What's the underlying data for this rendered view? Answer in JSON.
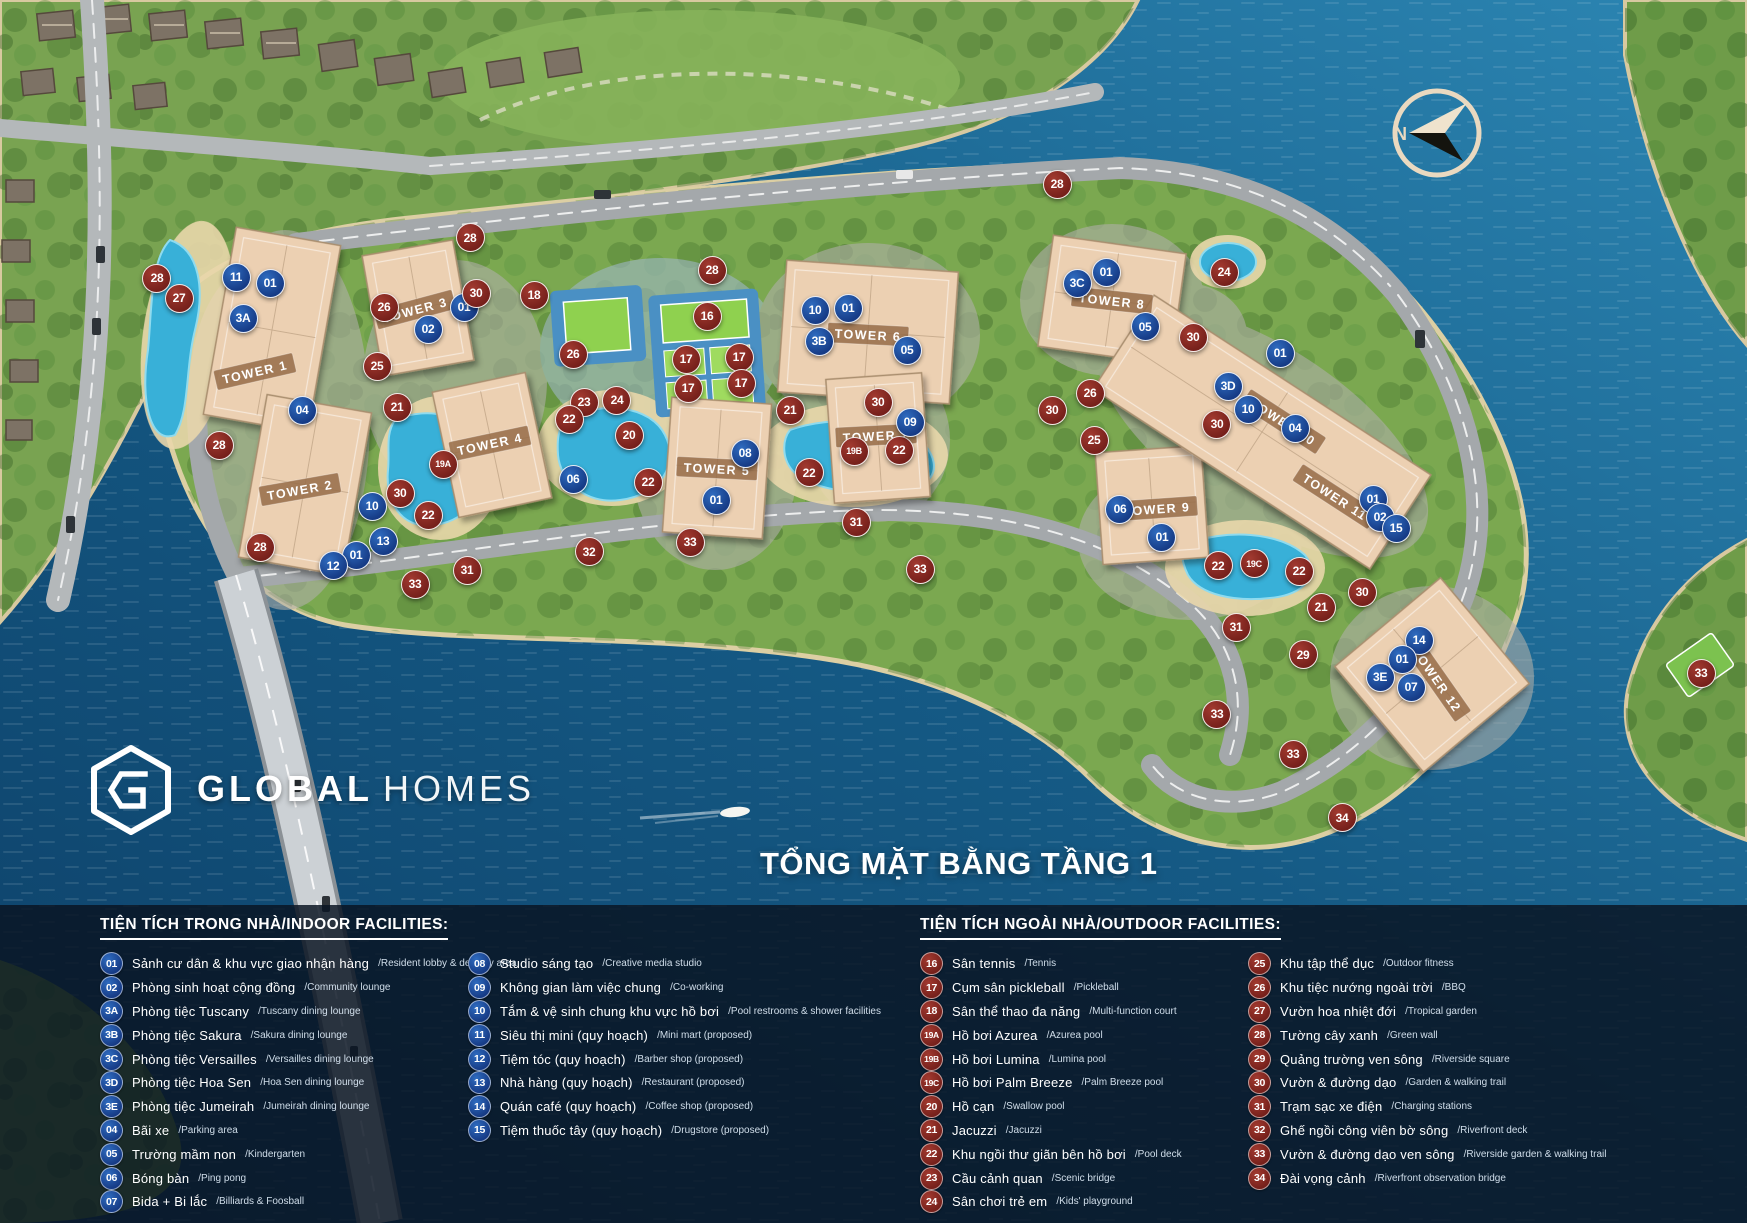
{
  "title": "TỔNG MẶT BẰNG TẦNG 1",
  "logo": {
    "bold": "GLOBAL",
    "light": "HOMES"
  },
  "compass": {
    "label": "N"
  },
  "palette": {
    "indoor_badge": "#1d4e9e",
    "outdoor_badge": "#8e2b28",
    "water": "#11557e",
    "land_green": "#79a351",
    "tower_fill": "#ecd0b2",
    "panel": "#0a1423",
    "pool": "#38b0d8"
  },
  "legend": {
    "indoor": {
      "header": "TIỆN TÍCH TRONG NHÀ/INDOOR FACILITIES:",
      "columns": [
        [
          {
            "id": "01",
            "vi": "Sảnh cư dân & khu vực giao nhận hàng",
            "en": "Resident lobby & delivery area"
          },
          {
            "id": "02",
            "vi": "Phòng sinh hoạt cộng đồng",
            "en": "Community lounge"
          },
          {
            "id": "3A",
            "vi": "Phòng tiệc Tuscany",
            "en": "Tuscany dining lounge"
          },
          {
            "id": "3B",
            "vi": "Phòng tiệc Sakura",
            "en": "Sakura dining lounge"
          },
          {
            "id": "3C",
            "vi": "Phòng tiệc Versailles",
            "en": "Versailles dining lounge"
          },
          {
            "id": "3D",
            "vi": "Phòng tiệc Hoa Sen",
            "en": "Hoa Sen dining lounge"
          },
          {
            "id": "3E",
            "vi": "Phòng tiệc Jumeirah",
            "en": "Jumeirah dining lounge"
          },
          {
            "id": "04",
            "vi": "Bãi xe",
            "en": "Parking area"
          },
          {
            "id": "05",
            "vi": "Trường mầm non",
            "en": "Kindergarten"
          },
          {
            "id": "06",
            "vi": "Bóng bàn",
            "en": "Ping pong"
          },
          {
            "id": "07",
            "vi": "Bida + Bi lắc",
            "en": "Billiards & Foosball"
          }
        ],
        [
          {
            "id": "08",
            "vi": "Studio sáng tạo",
            "en": "Creative media studio"
          },
          {
            "id": "09",
            "vi": "Không gian làm việc chung",
            "en": "Co-working"
          },
          {
            "id": "10",
            "vi": "Tắm & vệ sinh chung khu vực hồ bơi",
            "en": "Pool restrooms & shower facilities"
          },
          {
            "id": "11",
            "vi": "Siêu thị mini (quy hoạch)",
            "en": "Mini mart (proposed)"
          },
          {
            "id": "12",
            "vi": "Tiệm tóc (quy hoạch)",
            "en": "Barber shop (proposed)"
          },
          {
            "id": "13",
            "vi": "Nhà hàng (quy hoạch)",
            "en": "Restaurant (proposed)"
          },
          {
            "id": "14",
            "vi": "Quán café (quy hoạch)",
            "en": "Coffee shop (proposed)"
          },
          {
            "id": "15",
            "vi": "Tiệm thuốc tây (quy hoạch)",
            "en": "Drugstore (proposed)"
          }
        ]
      ]
    },
    "outdoor": {
      "header": "TIỆN TÍCH NGOÀI NHÀ/OUTDOOR FACILITIES:",
      "columns": [
        [
          {
            "id": "16",
            "vi": "Sân tennis",
            "en": "Tennis"
          },
          {
            "id": "17",
            "vi": "Cụm sân pickleball",
            "en": "Pickleball"
          },
          {
            "id": "18",
            "vi": "Sân thể thao đa năng",
            "en": "Multi-function court"
          },
          {
            "id": "19A",
            "vi": "Hồ bơi Azurea",
            "en": "Azurea pool"
          },
          {
            "id": "19B",
            "vi": "Hồ bơi Lumina",
            "en": "Lumina pool"
          },
          {
            "id": "19C",
            "vi": "Hồ bơi Palm Breeze",
            "en": "Palm Breeze pool"
          },
          {
            "id": "20",
            "vi": "Hồ cạn",
            "en": "Swallow pool"
          },
          {
            "id": "21",
            "vi": "Jacuzzi",
            "en": "Jacuzzi"
          },
          {
            "id": "22",
            "vi": "Khu ngồi thư giãn bên hồ bơi",
            "en": "Pool deck"
          },
          {
            "id": "23",
            "vi": "Cầu cảnh quan",
            "en": "Scenic bridge"
          },
          {
            "id": "24",
            "vi": "Sân chơi trẻ em",
            "en": "Kids' playground"
          }
        ],
        [
          {
            "id": "25",
            "vi": "Khu tập thể dục",
            "en": "Outdoor fitness"
          },
          {
            "id": "26",
            "vi": "Khu tiệc nướng ngoài trời",
            "en": "BBQ"
          },
          {
            "id": "27",
            "vi": "Vườn hoa nhiệt đới",
            "en": "Tropical garden"
          },
          {
            "id": "28",
            "vi": "Tường cây xanh",
            "en": "Green wall"
          },
          {
            "id": "29",
            "vi": "Quảng trường ven sông",
            "en": "Riverside square"
          },
          {
            "id": "30",
            "vi": "Vườn & đường dạo",
            "en": "Garden & walking trail"
          },
          {
            "id": "31",
            "vi": "Trạm sạc xe điện",
            "en": "Charging stations"
          },
          {
            "id": "32",
            "vi": "Ghế ngồi công viên bờ sông",
            "en": "Riverfront deck"
          },
          {
            "id": "33",
            "vi": "Vườn & đường dạo ven sông",
            "en": "Riverside garden & walking trail"
          },
          {
            "id": "34",
            "vi": "Đài vọng cảnh",
            "en": "Riverfront observation bridge"
          }
        ]
      ]
    }
  },
  "map": {
    "buildings": [
      {
        "x": 272,
        "y": 330,
        "w": 106,
        "h": 190,
        "rot": 10
      },
      {
        "x": 305,
        "y": 485,
        "w": 106,
        "h": 165,
        "rot": 10
      },
      {
        "x": 418,
        "y": 308,
        "w": 92,
        "h": 122,
        "rot": -10
      },
      {
        "x": 492,
        "y": 445,
        "w": 95,
        "h": 128,
        "rot": -12
      },
      {
        "x": 717,
        "y": 468,
        "w": 100,
        "h": 135,
        "rot": 4
      },
      {
        "x": 868,
        "y": 332,
        "w": 172,
        "h": 132,
        "rot": 4
      },
      {
        "x": 878,
        "y": 438,
        "w": 96,
        "h": 124,
        "rot": -4
      },
      {
        "x": 1112,
        "y": 300,
        "w": 134,
        "h": 112,
        "rot": 8
      },
      {
        "x": 1152,
        "y": 505,
        "w": 106,
        "h": 112,
        "rot": -4
      },
      {
        "x": 1262,
        "y": 432,
        "w": 330,
        "h": 112,
        "rot": 33
      },
      {
        "x": 1432,
        "y": 675,
        "w": 138,
        "h": 138,
        "rot": 50
      }
    ],
    "tower_labels": [
      {
        "text": "TOWER 1",
        "x": 255,
        "y": 372,
        "rot": -13
      },
      {
        "text": "TOWER 2",
        "x": 300,
        "y": 490,
        "rot": -10
      },
      {
        "text": "TOWER 3",
        "x": 415,
        "y": 310,
        "rot": -15
      },
      {
        "text": "TOWER 4",
        "x": 490,
        "y": 444,
        "rot": -12
      },
      {
        "text": "TOWER 5",
        "x": 717,
        "y": 469,
        "rot": 3
      },
      {
        "text": "TOWER 6",
        "x": 868,
        "y": 335,
        "rot": 3
      },
      {
        "text": "TOWER 7",
        "x": 876,
        "y": 436,
        "rot": -3
      },
      {
        "text": "TOWER 8",
        "x": 1112,
        "y": 301,
        "rot": 6
      },
      {
        "text": "TOWER 9",
        "x": 1157,
        "y": 509,
        "rot": -4
      },
      {
        "text": "TOWER 10",
        "x": 1283,
        "y": 422,
        "rot": 33
      },
      {
        "text": "TOWER 11",
        "x": 1335,
        "y": 497,
        "rot": 33
      },
      {
        "text": "TOWER 12",
        "x": 1437,
        "y": 680,
        "rot": 55
      }
    ],
    "markers": [
      {
        "id": "11",
        "t": "i",
        "x": 235,
        "y": 276
      },
      {
        "id": "01",
        "t": "i",
        "x": 269,
        "y": 282
      },
      {
        "id": "3A",
        "t": "i",
        "x": 242,
        "y": 317
      },
      {
        "id": "28",
        "t": "o",
        "x": 156,
        "y": 277
      },
      {
        "id": "27",
        "t": "o",
        "x": 178,
        "y": 297
      },
      {
        "id": "26",
        "t": "o",
        "x": 383,
        "y": 306
      },
      {
        "id": "25",
        "t": "o",
        "x": 376,
        "y": 365
      },
      {
        "id": "02",
        "t": "i",
        "x": 427,
        "y": 328
      },
      {
        "id": "01",
        "t": "i",
        "x": 463,
        "y": 306
      },
      {
        "id": "04",
        "t": "i",
        "x": 301,
        "y": 409
      },
      {
        "id": "28",
        "t": "o",
        "x": 218,
        "y": 444
      },
      {
        "id": "21",
        "t": "o",
        "x": 396,
        "y": 406
      },
      {
        "id": "19A",
        "t": "o",
        "x": 442,
        "y": 463
      },
      {
        "id": "30",
        "t": "o",
        "x": 399,
        "y": 492
      },
      {
        "id": "10",
        "t": "i",
        "x": 371,
        "y": 505
      },
      {
        "id": "22",
        "t": "o",
        "x": 427,
        "y": 514
      },
      {
        "id": "13",
        "t": "i",
        "x": 382,
        "y": 540
      },
      {
        "id": "01",
        "t": "i",
        "x": 355,
        "y": 554
      },
      {
        "id": "12",
        "t": "i",
        "x": 332,
        "y": 565
      },
      {
        "id": "28",
        "t": "o",
        "x": 259,
        "y": 546
      },
      {
        "id": "31",
        "t": "o",
        "x": 466,
        "y": 569
      },
      {
        "id": "33",
        "t": "o",
        "x": 414,
        "y": 583
      },
      {
        "id": "32",
        "t": "o",
        "x": 588,
        "y": 551
      },
      {
        "id": "33",
        "t": "o",
        "x": 689,
        "y": 541
      },
      {
        "id": "28",
        "t": "o",
        "x": 469,
        "y": 237
      },
      {
        "id": "30",
        "t": "o",
        "x": 475,
        "y": 292
      },
      {
        "id": "18",
        "t": "o",
        "x": 533,
        "y": 294
      },
      {
        "id": "28",
        "t": "o",
        "x": 711,
        "y": 269
      },
      {
        "id": "16",
        "t": "o",
        "x": 706,
        "y": 315
      },
      {
        "id": "17",
        "t": "o",
        "x": 685,
        "y": 358
      },
      {
        "id": "17",
        "t": "o",
        "x": 738,
        "y": 356
      },
      {
        "id": "17",
        "t": "o",
        "x": 687,
        "y": 387
      },
      {
        "id": "17",
        "t": "o",
        "x": 740,
        "y": 382
      },
      {
        "id": "26",
        "t": "o",
        "x": 572,
        "y": 353
      },
      {
        "id": "23",
        "t": "o",
        "x": 583,
        "y": 401
      },
      {
        "id": "24",
        "t": "o",
        "x": 616,
        "y": 399
      },
      {
        "id": "22",
        "t": "o",
        "x": 568,
        "y": 418
      },
      {
        "id": "20",
        "t": "o",
        "x": 628,
        "y": 434
      },
      {
        "id": "22",
        "t": "o",
        "x": 647,
        "y": 481
      },
      {
        "id": "06",
        "t": "i",
        "x": 572,
        "y": 478
      },
      {
        "id": "08",
        "t": "i",
        "x": 744,
        "y": 452
      },
      {
        "id": "01",
        "t": "i",
        "x": 715,
        "y": 499
      },
      {
        "id": "10",
        "t": "i",
        "x": 814,
        "y": 309
      },
      {
        "id": "01",
        "t": "i",
        "x": 847,
        "y": 307
      },
      {
        "id": "3B",
        "t": "i",
        "x": 818,
        "y": 340
      },
      {
        "id": "05",
        "t": "i",
        "x": 906,
        "y": 349
      },
      {
        "id": "30",
        "t": "o",
        "x": 877,
        "y": 401
      },
      {
        "id": "21",
        "t": "o",
        "x": 789,
        "y": 409
      },
      {
        "id": "19B",
        "t": "o",
        "x": 853,
        "y": 450
      },
      {
        "id": "22",
        "t": "o",
        "x": 898,
        "y": 449
      },
      {
        "id": "22",
        "t": "o",
        "x": 808,
        "y": 472
      },
      {
        "id": "31",
        "t": "o",
        "x": 855,
        "y": 521
      },
      {
        "id": "09",
        "t": "i",
        "x": 909,
        "y": 421
      },
      {
        "id": "33",
        "t": "o",
        "x": 919,
        "y": 568
      },
      {
        "id": "28",
        "t": "o",
        "x": 1056,
        "y": 183
      },
      {
        "id": "24",
        "t": "o",
        "x": 1223,
        "y": 271
      },
      {
        "id": "3C",
        "t": "i",
        "x": 1076,
        "y": 282
      },
      {
        "id": "01",
        "t": "i",
        "x": 1105,
        "y": 271
      },
      {
        "id": "05",
        "t": "i",
        "x": 1144,
        "y": 326
      },
      {
        "id": "30",
        "t": "o",
        "x": 1192,
        "y": 336
      },
      {
        "id": "26",
        "t": "o",
        "x": 1089,
        "y": 392
      },
      {
        "id": "30",
        "t": "o",
        "x": 1051,
        "y": 409
      },
      {
        "id": "25",
        "t": "o",
        "x": 1093,
        "y": 439
      },
      {
        "id": "01",
        "t": "i",
        "x": 1279,
        "y": 352
      },
      {
        "id": "3D",
        "t": "i",
        "x": 1227,
        "y": 385
      },
      {
        "id": "10",
        "t": "i",
        "x": 1247,
        "y": 408
      },
      {
        "id": "04",
        "t": "i",
        "x": 1294,
        "y": 427
      },
      {
        "id": "30",
        "t": "o",
        "x": 1216,
        "y": 423
      },
      {
        "id": "06",
        "t": "i",
        "x": 1119,
        "y": 508
      },
      {
        "id": "01",
        "t": "i",
        "x": 1161,
        "y": 536
      },
      {
        "id": "01",
        "t": "i",
        "x": 1372,
        "y": 498
      },
      {
        "id": "02",
        "t": "i",
        "x": 1379,
        "y": 516
      },
      {
        "id": "15",
        "t": "i",
        "x": 1395,
        "y": 527
      },
      {
        "id": "22",
        "t": "o",
        "x": 1217,
        "y": 565
      },
      {
        "id": "19C",
        "t": "o",
        "x": 1253,
        "y": 563
      },
      {
        "id": "22",
        "t": "o",
        "x": 1298,
        "y": 570
      },
      {
        "id": "30",
        "t": "o",
        "x": 1361,
        "y": 591
      },
      {
        "id": "21",
        "t": "o",
        "x": 1320,
        "y": 606
      },
      {
        "id": "31",
        "t": "o",
        "x": 1235,
        "y": 626
      },
      {
        "id": "29",
        "t": "o",
        "x": 1302,
        "y": 654
      },
      {
        "id": "33",
        "t": "o",
        "x": 1216,
        "y": 713
      },
      {
        "id": "14",
        "t": "i",
        "x": 1418,
        "y": 639
      },
      {
        "id": "01",
        "t": "i",
        "x": 1401,
        "y": 658
      },
      {
        "id": "3E",
        "t": "i",
        "x": 1379,
        "y": 676
      },
      {
        "id": "07",
        "t": "i",
        "x": 1410,
        "y": 686
      },
      {
        "id": "33",
        "t": "o",
        "x": 1292,
        "y": 753
      },
      {
        "id": "34",
        "t": "o",
        "x": 1341,
        "y": 817
      },
      {
        "id": "33",
        "t": "o",
        "x": 1700,
        "y": 672
      }
    ]
  }
}
